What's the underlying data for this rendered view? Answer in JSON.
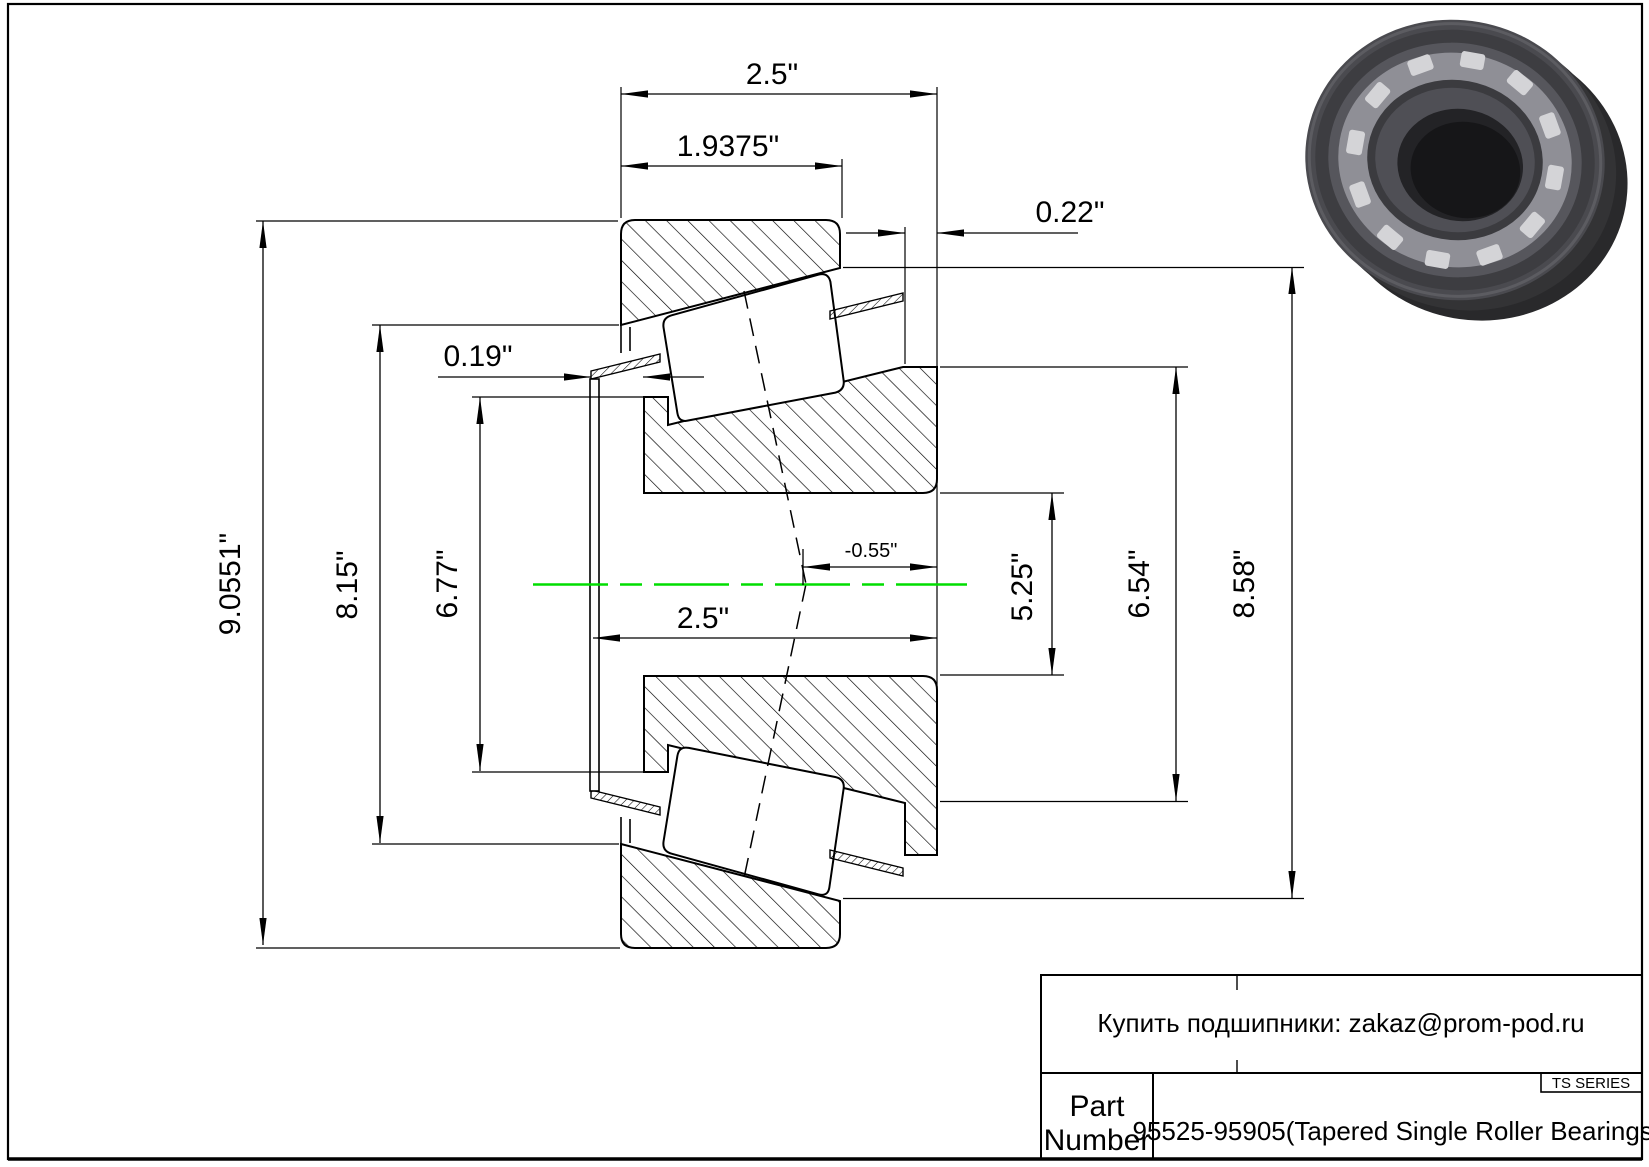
{
  "drawing": {
    "dimensions": {
      "overall_width_top": "2.5\"",
      "cup_width": "1.9375\"",
      "cup_front_standout": "0.22\"",
      "flinger_standout": "0.19\"",
      "max_outer_diameter": "9.0551\"",
      "cup_raceway_diameter": "8.15\"",
      "cone_front_diameter": "6.77\"",
      "cone_width": "2.5\"",
      "effective_center": "-0.55\"",
      "bore_reference_diameter": "5.25\"",
      "cone_back_diameter": "6.54\"",
      "cup_outer_diameter": "8.58\""
    },
    "colors": {
      "centerline": "#00dd00",
      "line": "#000000"
    }
  },
  "title_block": {
    "contact": "Купить подшипники: zakaz@prom-pod.ru",
    "series_badge": "TS SERIES",
    "part_label_line1": "Part",
    "part_label_line2": "Number",
    "part_value": "95525-95905(Tapered Single Roller Bearings)"
  }
}
